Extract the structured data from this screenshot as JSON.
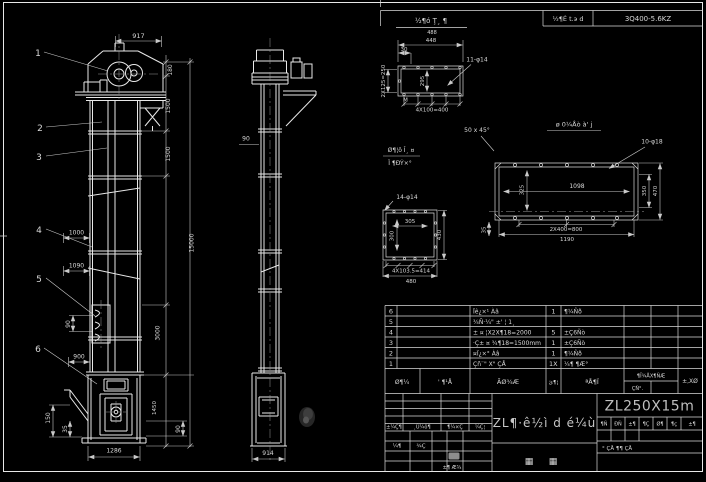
{
  "colors": {
    "background": "#000000",
    "line": "#e8e8e8",
    "dim": "#c9c9c9",
    "text": "#d8d8d8"
  },
  "top_bar": {
    "note_numerator": "½¶ó Ţ¸ ¶",
    "note_denominator": "488",
    "cell_left": "½¶É t.э d",
    "cell_right": "3Q400-5.6KZ"
  },
  "front_view": {
    "balloons": [
      "1",
      "2",
      "3",
      "4",
      "5",
      "6"
    ],
    "dims": {
      "d917": "917",
      "d180": "180",
      "d1500a": "1500",
      "d1500b": "1500",
      "d15000": "15000",
      "d3000": "3000",
      "d1450": "1450",
      "d1000": "1000",
      "d1090": "1090",
      "d90_pitch": "90",
      "d900": "900",
      "d150": "150",
      "d35_left": "35",
      "d90_right": "90",
      "d1286": "1286"
    }
  },
  "side_view": {
    "dims": {
      "d90": "90",
      "d914": "914"
    }
  },
  "detail_top_flange": {
    "dims": {
      "overall": "448",
      "d30": "30",
      "holes": "11-φ14",
      "left": "2X125=250",
      "inner": "295",
      "weld": "M",
      "bottom": "4X100=400"
    },
    "note_chamfer": "50 x 45°"
  },
  "detail_long_flange": {
    "title": "ø 0¼Åò à' j",
    "dims": {
      "holes": "10-φ18",
      "d1098": "1098",
      "d325": "325",
      "d350": "350",
      "d470": "470",
      "bottom1": "2X400=800",
      "bottom2": "1190",
      "d35": "35"
    }
  },
  "detail_square_flange": {
    "title_line1": "Ø¶¦ô Î¸ ¤",
    "title_line2": "Ï ¶ÐÝ×°",
    "dims": {
      "holes": "14-φ14",
      "inner_h": "305",
      "inner_v": "300",
      "right": "430",
      "bottom1": "4X103.5=414",
      "bottom2": "480"
    }
  },
  "parts_table": {
    "rows": [
      {
        "no": "6",
        "name": "Ïê¿×¹ Àâ",
        "qty": "1",
        "mat": "¶¼Ñð",
        "rem": ""
      },
      {
        "no": "5",
        "name": "¾Ñ·¼\" ±' ¦ 1¸",
        "qty": "",
        "mat": "",
        "rem": ""
      },
      {
        "no": "4",
        "name": "± ¤ ¦X2X¶18=2000",
        "qty": "5",
        "mat": "±Ç6Ñò",
        "rem": ""
      },
      {
        "no": "3",
        "name": "·Ç± ¤ ¾¶18=1500mm",
        "qty": "1",
        "mat": "±Ç6Ñò",
        "rem": ""
      },
      {
        "no": "2",
        "name": "¤Ï¿×° Àâ",
        "qty": "1",
        "mat": "¶¼Ñð",
        "rem": ""
      },
      {
        "no": "1",
        "name": "Çñ¨\" X\" ÇÅ",
        "qty": "1X",
        "mat": "¼¶ ¶Æ°",
        "rem": ""
      }
    ],
    "header": {
      "no": "Ø¶¼",
      "code": "' ¶¹Å",
      "name": "ÃØ¾Æ",
      "qty": "ئ¶¦",
      "mat": "ªÅ¶Ï",
      "weight": "¶Ï¾ÅX¶ÑÆ",
      "weight_sub": "ÇÑ°.",
      "rem": "±,XØ"
    }
  },
  "title_block": {
    "product": "ZL¶·ê½ì d é¼ù",
    "model": "ZL250X15m",
    "drawing_type_left": "▦",
    "drawing_type_right": "▦",
    "revision_labels": [
      "±¼Ç¶",
      "¸Ù¼ô¶",
      "¶¼×Ç",
      "¼Ç¦"
    ],
    "sig_left": "¼¶",
    "sig_right": "¾Ç",
    "stamp_note": "±¶ Æ¾",
    "scale_labels": [
      "¶Ñ",
      "ÐÑ",
      "±¶",
      "¶Ç",
      "Ø¶",
      "¶ç",
      "±¶"
    ],
    "sheet_row": "°  ÇÅ    ¶¶  ÇÅ"
  }
}
